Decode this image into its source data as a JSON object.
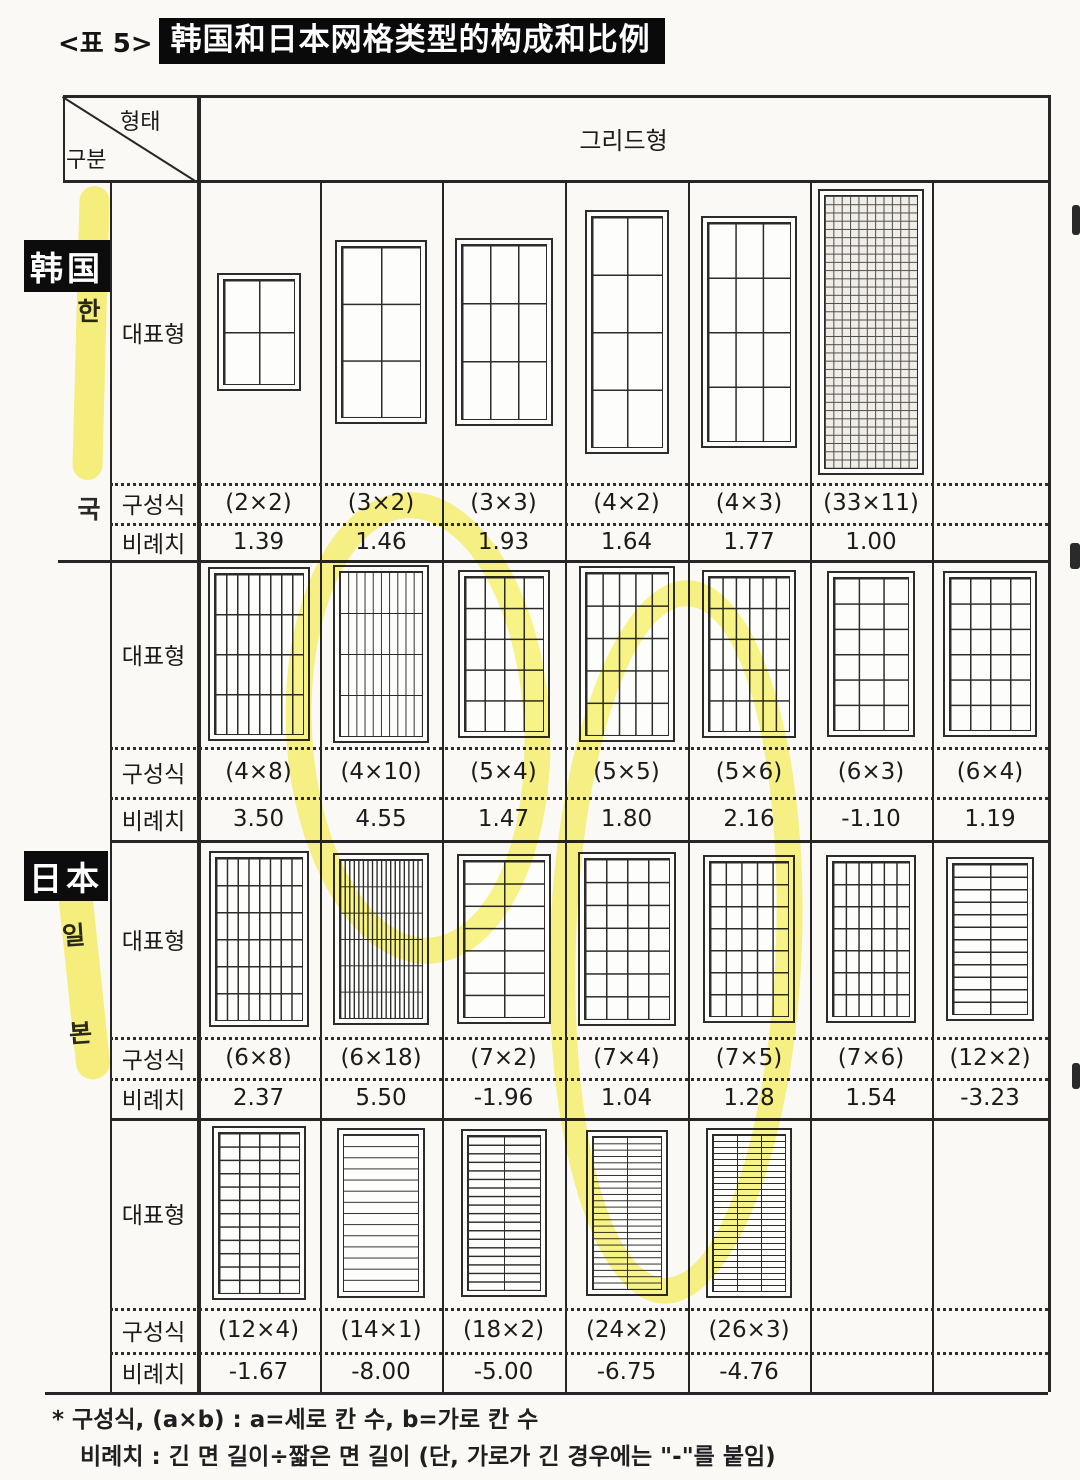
{
  "title": {
    "index": "<표 5>",
    "text": "韩国和日本网格类型的构成和比例"
  },
  "table_header": {
    "corner_top_right": "형태",
    "corner_bottom_left": "구분",
    "grid_type": "그리드형"
  },
  "row_labels": {
    "representative": "대표형",
    "composition": "구성식",
    "proportion": "비례치"
  },
  "countries": [
    {
      "id": "korea",
      "overlay": "韩国",
      "vertical": "한국"
    },
    {
      "id": "japan",
      "overlay": "日本",
      "vertical": "일본"
    }
  ],
  "sections": [
    {
      "country": "korea",
      "cells": [
        {
          "comp": "(2×2)",
          "prop": "1.39",
          "rows": 2,
          "cols": 2
        },
        {
          "comp": "(3×2)",
          "prop": "1.46",
          "rows": 3,
          "cols": 2
        },
        {
          "comp": "(3×3)",
          "prop": "1.93",
          "rows": 3,
          "cols": 3
        },
        {
          "comp": "(4×2)",
          "prop": "1.64",
          "rows": 4,
          "cols": 2
        },
        {
          "comp": "(4×3)",
          "prop": "1.77",
          "rows": 4,
          "cols": 3
        },
        {
          "comp": "(33×11)",
          "prop": "1.00",
          "rows": 33,
          "cols": 11
        },
        null
      ]
    },
    {
      "country": "japan",
      "cells": [
        {
          "comp": "(4×8)",
          "prop": "3.50",
          "rows": 4,
          "cols": 8
        },
        {
          "comp": "(4×10)",
          "prop": "4.55",
          "rows": 4,
          "cols": 10
        },
        {
          "comp": "(5×4)",
          "prop": "1.47",
          "rows": 5,
          "cols": 4
        },
        {
          "comp": "(5×5)",
          "prop": "1.80",
          "rows": 5,
          "cols": 5
        },
        {
          "comp": "(5×6)",
          "prop": "2.16",
          "rows": 5,
          "cols": 6
        },
        {
          "comp": "(6×3)",
          "prop": "-1.10",
          "rows": 6,
          "cols": 3
        },
        {
          "comp": "(6×4)",
          "prop": "1.19",
          "rows": 6,
          "cols": 4
        }
      ]
    },
    {
      "country": "japan",
      "cells": [
        {
          "comp": "(6×8)",
          "prop": "2.37",
          "rows": 6,
          "cols": 8
        },
        {
          "comp": "(6×18)",
          "prop": "5.50",
          "rows": 6,
          "cols": 18
        },
        {
          "comp": "(7×2)",
          "prop": "-1.96",
          "rows": 7,
          "cols": 2
        },
        {
          "comp": "(7×4)",
          "prop": "1.04",
          "rows": 7,
          "cols": 4
        },
        {
          "comp": "(7×5)",
          "prop": "1.28",
          "rows": 7,
          "cols": 5
        },
        {
          "comp": "(7×6)",
          "prop": "1.54",
          "rows": 7,
          "cols": 6
        },
        {
          "comp": "(12×2)",
          "prop": "-3.23",
          "rows": 12,
          "cols": 2
        }
      ]
    },
    {
      "country": "japan",
      "cells": [
        {
          "comp": "(12×4)",
          "prop": "-1.67",
          "rows": 12,
          "cols": 4
        },
        {
          "comp": "(14×1)",
          "prop": "-8.00",
          "rows": 14,
          "cols": 1
        },
        {
          "comp": "(18×2)",
          "prop": "-5.00",
          "rows": 18,
          "cols": 2
        },
        {
          "comp": "(24×2)",
          "prop": "-6.75",
          "rows": 24,
          "cols": 2
        },
        {
          "comp": "(26×3)",
          "prop": "-4.76",
          "rows": 26,
          "cols": 3
        },
        null,
        null
      ]
    }
  ],
  "footnotes": [
    "* 구성식, (a×b) : a=세로 칸 수, b=가로 칸 수",
    "비례치 : 긴 면 길이÷짧은 면 길이 (단, 가로가 긴 경우에는 \"-\"를 붙임)"
  ],
  "colors": {
    "highlight": "#f7ee34",
    "ink": "#262626",
    "paper": "#faf9f6",
    "label_box": "#0c0c0c"
  }
}
